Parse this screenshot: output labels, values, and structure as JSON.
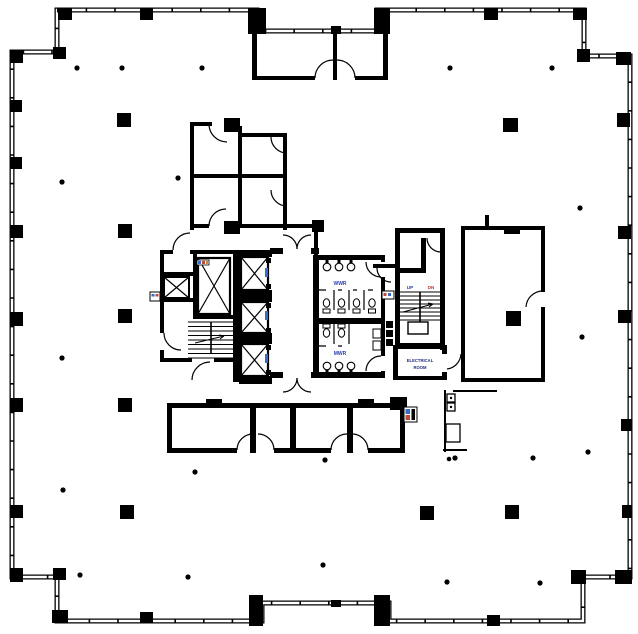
{
  "drawing": {
    "type": "architectural-floor-plan",
    "labels": {
      "womens_washroom": "WWR",
      "mens_washroom": "MWR",
      "electrical_room_line1": "ELECTRICAL",
      "electrical_room_line2": "ROOM",
      "stair_up": "UP",
      "stair_down": "DN"
    },
    "colors": {
      "walls": "#000000",
      "background": "#ffffff",
      "washroom_label": "#2a3db0",
      "up_label": "#2a3db0",
      "down_label": "#c03030",
      "electrical_label": "#1f2a80",
      "fixture_accent_blue": "#3a6ac8",
      "fixture_accent_red": "#c04a3a",
      "fixture_accent_orange": "#d08a3a"
    },
    "symbols": [
      "elevator-shaft-x-symbol",
      "stair-treads-symbol",
      "door-swing-arc-symbol",
      "toilet-symbol",
      "sink-symbol",
      "urinal-symbol",
      "column-marker-symbol",
      "grid-dot-marker-symbol",
      "wall-mullion-tick-symbol"
    ]
  }
}
